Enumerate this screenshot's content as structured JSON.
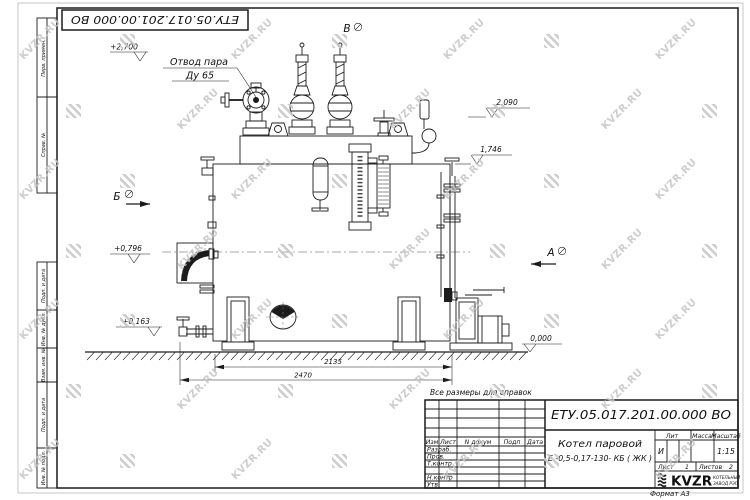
{
  "watermark": {
    "text": "KVZR.RU"
  },
  "colors": {
    "line": "#1c1c1c",
    "watermark": "#c5c5c5",
    "paper": "#ffffff"
  },
  "sheet": {
    "ref_note": "Все размеры для справок",
    "format_note": "Формат А3",
    "stamps_top": [
      {
        "label": "Перв. примен."
      },
      {
        "label": "Справ. №"
      }
    ],
    "stamps_bottom": [
      {
        "label": "Подп. и дата"
      },
      {
        "label": "Инв. № дубл."
      },
      {
        "label": "Взам. инв. №"
      },
      {
        "label": "Подп. и дата"
      },
      {
        "label": "Инв. № подл."
      }
    ]
  },
  "annotations": {
    "steam_outlet": {
      "line1": "Отвод пара",
      "line2": "Ду 65"
    },
    "views": {
      "a": "А",
      "b": "В",
      "g": "Б"
    },
    "elevations": {
      "top": "+2,700",
      "right_upper": "2,090",
      "right_lower": "1,746",
      "left_upper": "+0,796",
      "left_lower": "+0,163",
      "ground": "0,000"
    },
    "dimensions": {
      "inner": "2135",
      "outer": "2470"
    }
  },
  "title_block": {
    "doc_number": "ЕТУ.05.017.201.00.000  ВО",
    "product_line1": "Котел паровой",
    "product_line2": "Е -0,5-0,17-130- КБ ( ЖК )",
    "col_headers": {
      "izm": "Изм",
      "list": "Лист",
      "doc": "N докум",
      "sign": "Подп",
      "date": "Дата"
    },
    "row_labels": {
      "razrab": "Разраб.",
      "prov": "Пров.",
      "tkontr": "Т.контр",
      "nkontr": "Н.контр",
      "utv": "Утв."
    },
    "lit_header": "Лит",
    "mass_header": "Масса",
    "scale_header": "Масштаб",
    "lit_value": "И",
    "scale_value": "1:15",
    "sheet_word": "Лист",
    "sheet_num": "1",
    "sheets_word": "Листов",
    "sheets_num": "2",
    "brand": {
      "name": "KVZR",
      "tagline1": "КОТЕЛЬНЫЙ",
      "tagline2": "ЗАВОД РЭП"
    }
  }
}
